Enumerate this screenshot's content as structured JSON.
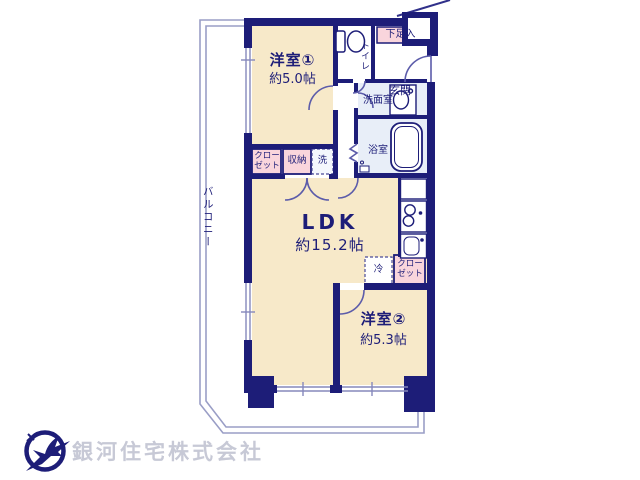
{
  "plan": {
    "rooms": {
      "western1": {
        "name": "洋室①",
        "size": "約5.0帖"
      },
      "ldk": {
        "name": "LDK",
        "size": "約15.2帖"
      },
      "western2": {
        "name": "洋室②",
        "size": "約5.3帖"
      }
    },
    "labels": {
      "entrance": "玄関",
      "shoe_box": "下足入",
      "toilet": "トイレ",
      "washroom": "洗面室",
      "bathroom": "浴室",
      "closet1": "クローゼット",
      "storage": "収納",
      "washer": "洗",
      "fridge": "冷",
      "closet2": "クローゼット",
      "balcony": "バルコニー"
    },
    "icons": {
      "toilet": "toilet-icon",
      "washbasin": "washbasin-icon",
      "bathtub": "bathtub-icon",
      "stove": "stove-icon",
      "kitchen_sink": "kitchen-sink-icon",
      "window": "window-icon",
      "door": "door-arc-icon",
      "logo": "swallow-circle-logo-icon"
    },
    "colors": {
      "wall": "#1d1d78",
      "room_fill": "#f7e9c9",
      "wet_area_fill": "#e8eef8",
      "closet_fill": "#f9d5dc",
      "balcony_line": "#9a9ec6"
    }
  },
  "footer": {
    "company": "銀河住宅株式会社"
  }
}
